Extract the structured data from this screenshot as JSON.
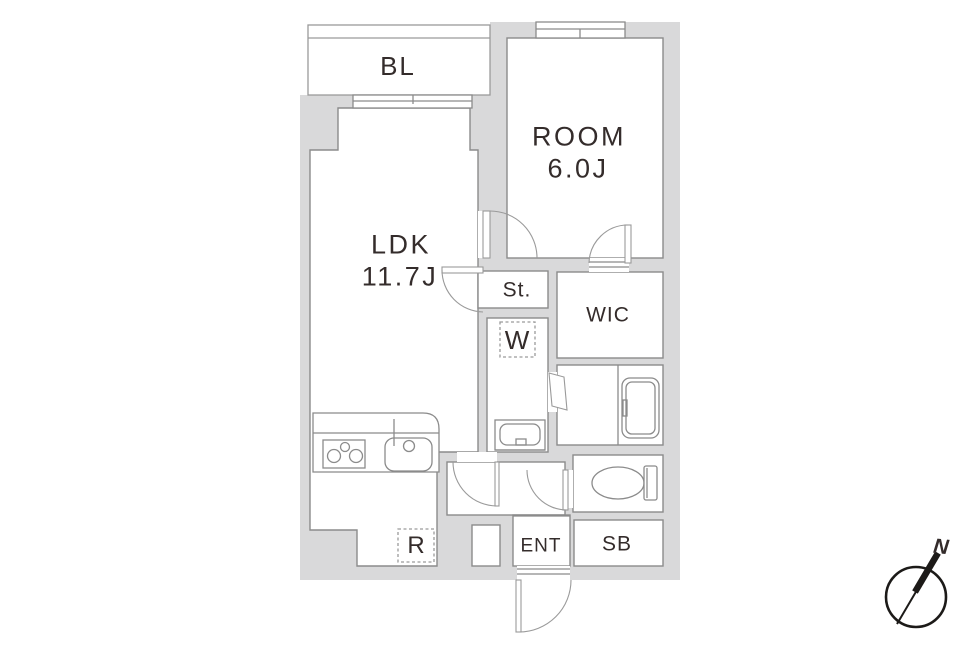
{
  "rooms": {
    "balcony": "BL",
    "bedroom_label": "ROOM",
    "bedroom_size": "6.0J",
    "ldk_label": "LDK",
    "ldk_size": "11.7J",
    "storage": "St.",
    "washer": "W",
    "wic": "WIC",
    "refrigerator": "R",
    "entrance": "ENT",
    "shoebox": "SB"
  },
  "compass": {
    "north": "N"
  },
  "colors": {
    "wall_fill": "#d9d9da",
    "room_stroke": "#8b8b8b",
    "line": "#9a9a9a",
    "text": "#342c2b",
    "compass": "#1c1a18"
  }
}
